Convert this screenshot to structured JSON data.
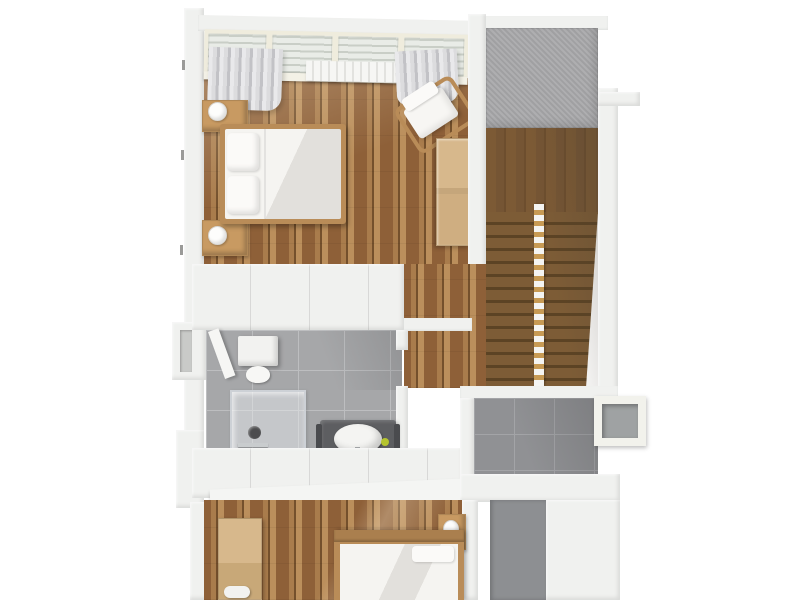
{
  "scene": {
    "type": "3d-floorplan-render",
    "view": "top-down dollhouse cutaway, upper floor",
    "visible_text": "none",
    "rooms": [
      {
        "name": "bedroom-master",
        "floor_material": "wood-planks",
        "items": [
          "panoramic-window-band",
          "curtain-left",
          "curtain-right",
          "radiator",
          "double-bed",
          "pillow",
          "pillow",
          "nightstand",
          "nightstand",
          "table-lamp",
          "table-lamp",
          "armchair",
          "wardrobe"
        ]
      },
      {
        "name": "stair-hall",
        "floor_material": "wood",
        "items": [
          "landing",
          "stair-flight-left",
          "stair-flight-right",
          "center-railing"
        ]
      },
      {
        "name": "hallway",
        "floor_material": "wood-planks",
        "items": [
          "door-lintel"
        ]
      },
      {
        "name": "bathroom",
        "floor_material": "gray-tiles",
        "items": [
          "toilet-cistern",
          "toilet-bowl",
          "shower-enclosure",
          "shower-drain",
          "vanity",
          "washbasin",
          "soap-accent",
          "open-door"
        ]
      },
      {
        "name": "utility-room",
        "floor_material": "gray-tiles",
        "items": [
          "side-window"
        ]
      },
      {
        "name": "bedroom-second",
        "floor_material": "wood-planks",
        "items": [
          "double-bed",
          "headboard",
          "nightstand",
          "table-lamp",
          "desk",
          "white-stool"
        ]
      },
      {
        "name": "roof-terrace",
        "floor_material": "gray-concrete",
        "items": []
      }
    ],
    "palette": {
      "wall": "#f0f1ef",
      "wallShade": "#d5d6d4",
      "wood": "#8e6038",
      "woodLight": "#a97c4c",
      "woodLighter": "#bb8f5c",
      "woodDark": "#74502c",
      "landing": "#7c5a35",
      "stair": "#7d5c36",
      "stairEdge": "#5c4324",
      "tile": "#a6a7a9",
      "tileGrout": "#bdbec0",
      "tileDark": "#909194",
      "tileDarkGrout": "#a3a4a7",
      "roof": "#a9a9ab",
      "glass": "#e9ece7",
      "curtain": "#dcdcde",
      "curtainShade": "#c2c2c6",
      "bedding": "#f5f4f1",
      "beddingShade": "#e2e0dc",
      "frameWood": "#b98c58",
      "furnitureWood": "#d7b88c",
      "nightstandWood": "#c89a62",
      "vanity": "#5d5e61",
      "accent": "#b5c42f",
      "railing": "#f4f4f2",
      "handrail": "#c79a54"
    }
  }
}
